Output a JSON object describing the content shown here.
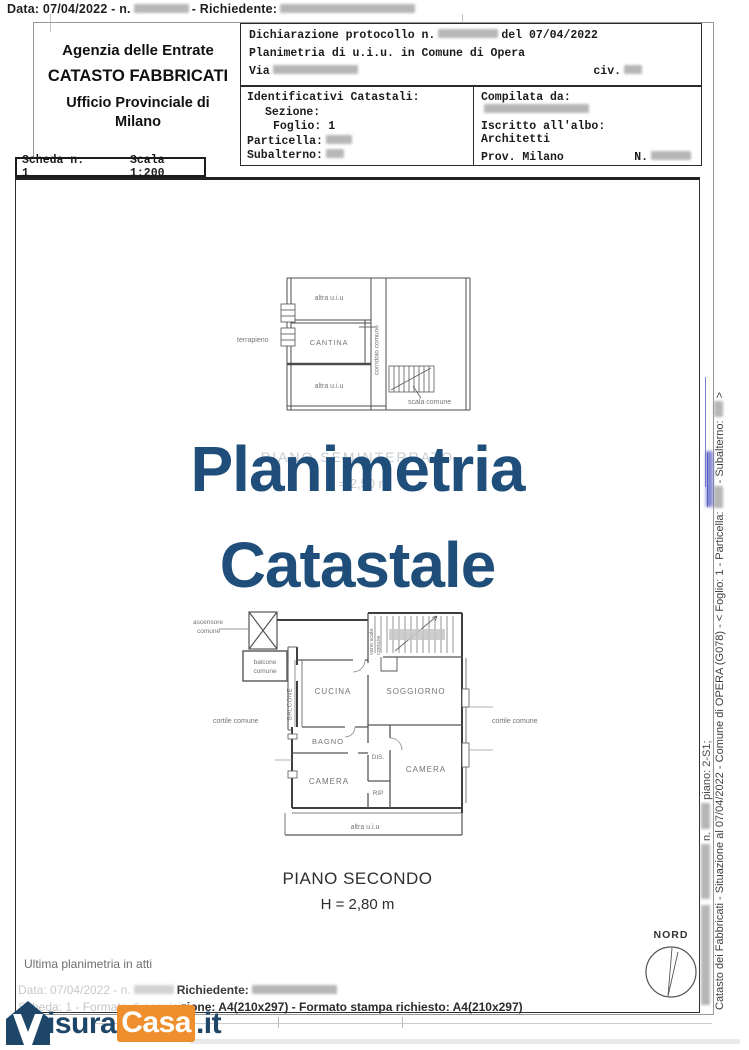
{
  "top_bar": {
    "prefix": "Data: 07/04/2022  -  n.",
    "richiedente": "-  Richiedente:"
  },
  "agency": {
    "line1": "Agenzia delle Entrate",
    "line2": "CATASTO FABBRICATI",
    "line3": "Ufficio Provinciale di",
    "line4": "Milano"
  },
  "declaration": {
    "row1_a": "Dichiarazione protocollo n.",
    "row1_b": "del 07/04/2022",
    "row2": "Planimetria di u.i.u. in Comune di Opera",
    "row3_a": "Via",
    "row3_b": "civ."
  },
  "identifiers": {
    "title": "Identificativi Catastali:",
    "sezione": "Sezione:",
    "foglio": "Foglio: 1",
    "particella": "Particella:",
    "subalterno": "Subalterno:"
  },
  "compilata": {
    "title": "Compilata da:",
    "albo_label": "Iscritto all'albo:",
    "albo": "Architetti",
    "prov": "Prov. Milano",
    "n": "N."
  },
  "scheda": {
    "left": "Scheda n. 1",
    "right": "Scala 1:200"
  },
  "watermark": {
    "line1": "Planimetria",
    "line2": "Catastale",
    "color": "#1e4e79"
  },
  "ghost": {
    "line1": "PIANO SEMINTERRATO",
    "line2": "H = 2,50 m"
  },
  "upper_plan": {
    "altra_top": "altra u.i.u",
    "terrapieno": "terrapieno",
    "cantina": "CANTINA",
    "corridoio": "corridoio comune",
    "altra_bottom": "altra u.i.u",
    "scala_comune": "scala comune"
  },
  "main_plan": {
    "ascensore1": "ascensore",
    "ascensore2": "comune",
    "balcone_comune1": "balcone",
    "balcone_comune2": "comune",
    "balcone": "BALCONE",
    "cucina": "CUCINA",
    "vano_scala1": "vano scala",
    "vano_scala2": "comune",
    "soggiorno": "SOGGIORNO",
    "cortile_sx": "cortile comune",
    "cortile_dx": "cortile comune",
    "bagno": "BAGNO",
    "dis": "DIS.",
    "camera_sx": "CAMERA",
    "rip": "RIP",
    "camera_dx": "CAMERA",
    "altra": "altra u.i.u"
  },
  "caption": {
    "line1": "PIANO SECONDO",
    "line2": "H = 2,80 m"
  },
  "compass": {
    "label": "NORD"
  },
  "side_text": {
    "l1a": "Catasto dei Fabbricati - Situazione al 07/04/2022 - Comune di OPERA (G078) -  <  Foglio: 1 - Particella:",
    "l1b": "- Subalterno:",
    "l1c": ">",
    "l2a": "n.",
    "l2b": "piano: 2-S1;"
  },
  "footer": {
    "ultima": "Ultima planimetria in atti",
    "l2_faint": "Data: 07/04/2022  -  n.",
    "l2_label": "Richiedente:",
    "l3_faint": "Scheda: 1 - Formato di acquisi",
    "l3_dark": "zione: A4(210x297)   -  Formato stampa richiesto: A4(210x297)"
  },
  "logo": {
    "isura": "isura",
    "casa": "Casa",
    "it": ".it",
    "blue": "#1d4668",
    "orange": "#ee8e2c"
  }
}
